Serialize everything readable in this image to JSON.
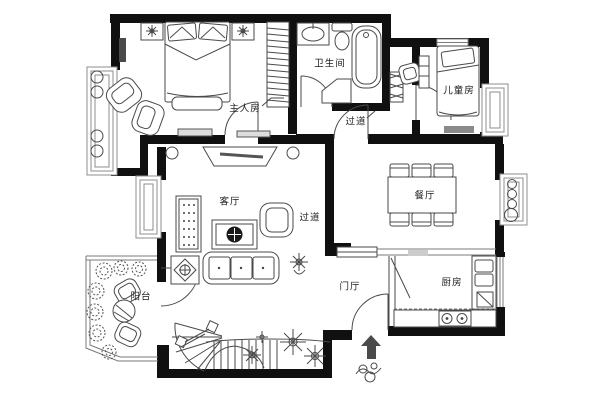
{
  "document": {
    "kind": "apartment floor plan",
    "language": "zh-CN"
  },
  "rooms": {
    "master_bedroom": {
      "label": "主人房"
    },
    "bathroom": {
      "label": "卫生间"
    },
    "hallway_upper": {
      "label": "过道"
    },
    "kids_room": {
      "label": "儿童房"
    },
    "living_room": {
      "label": "客厅"
    },
    "hallway_lower": {
      "label": "过道"
    },
    "dining_room": {
      "label": "餐厅"
    },
    "entry_hall": {
      "label": "门厅"
    },
    "kitchen": {
      "label": "厨房"
    },
    "balcony": {
      "label": "阳台"
    }
  },
  "symbols": {
    "entrance_arrow": "entrance-direction-arrow",
    "staircase": "curved-staircase",
    "plants": "planting-clusters"
  },
  "colors": {
    "wall": "#101010",
    "line": "#4a4a4a",
    "window": "#8e8e8e",
    "background": "#ffffff"
  }
}
